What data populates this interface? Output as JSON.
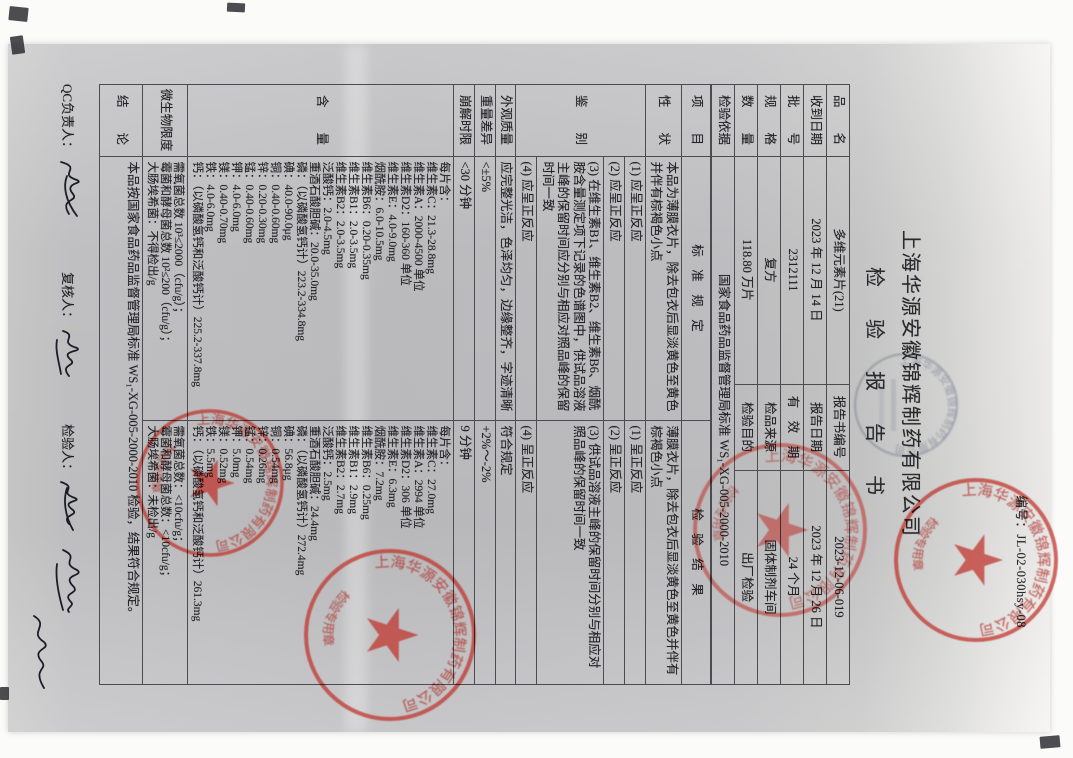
{
  "page": {
    "report_no": "编号：JL-02-030hsy-08",
    "company": "上海华源安徽锦辉制药有限公司",
    "title": "检　验　报　告　书"
  },
  "info": {
    "rows": [
      {
        "l1": "品　　名",
        "v1": "多维元素片(21)",
        "l2": "报告书编号",
        "v2": "2023-12-06-019"
      },
      {
        "l1": "收到日期",
        "v1": "2023 年 12 月 14 日",
        "l2": "报告日期",
        "v2": "2023 年 12 月 26 日"
      },
      {
        "l1": "批　　号",
        "v1": "2312111",
        "l2": "有　效　期",
        "v2": "24 个月"
      },
      {
        "l1": "规　　格",
        "v1": "复方",
        "l2": "检品来源",
        "v2": "固体制剂车间"
      },
      {
        "l1": "数　　量",
        "v1": "118.80 万片",
        "l2": "检验目的",
        "v2": "出厂检验"
      }
    ],
    "basis_label": "检验依据",
    "basis_value": "国家食品药品监督管理局标准 WS₁-XG-005-2000-2010"
  },
  "spec_header": {
    "item": "项　　目",
    "standard": "标　准　规　定",
    "result": "检　验　结　果"
  },
  "rows": {
    "xingzhuang": {
      "label": "性　　状",
      "std": "本品为薄膜衣片，除去包衣后显淡黄色至黄色并伴有棕褐色小点",
      "res": "薄膜衣片，除去包衣后显淡黄色至黄色并伴有棕褐色小点"
    },
    "jianbie": {
      "label": "鉴　　别",
      "subs": [
        {
          "std": "(1) 应呈正反应",
          "res": "(1) 呈正反应"
        },
        {
          "std": "(2) 应呈正反应",
          "res": "(2) 呈正反应"
        },
        {
          "std": "(3) 在维生素B1、维生素B2、维生素B6、烟酰胺含量测定项下记录的色谱图中，供试品溶液主峰的保留时间应分别与相应对照品峰的保留时间一致",
          "res": "(3) 供试品溶液主峰的保留时间分别与相应对照品峰的保留时间一致"
        },
        {
          "std": "(4) 应呈正反应",
          "res": "(4) 呈正反应"
        }
      ]
    },
    "waiguan": {
      "label": "外观质量",
      "std": "应完整光洁，色泽均匀，边缘整齐，字迹清晰",
      "res": "符合规定"
    },
    "zhongliang": {
      "label": "重量差异",
      "std": "<±5%",
      "res": "+2%～-2%"
    },
    "bengjie": {
      "label": "崩解时限",
      "std": "<30 分钟",
      "res": "9 分钟"
    },
    "hanliang": {
      "label": "含　　量",
      "std_lines": [
        "每片含：",
        "维生素C：21.3-28.8mg",
        "维生素A：2000-4500 单位",
        "维生素D2：160-360 单位",
        "维生素E：4.0-9.0mg",
        "烟酰胺：6.0-10.5mg",
        "维生素B6：0.20-0.35mg",
        "维生素B1：2.0-3.5mg",
        "维生素B2：2.0-3.5mg",
        "泛酸钙：2.0-4.5mg",
        "重酒石酸胆碱：20.0-35.0mg",
        "磷：（以磷酸氢钙计）223.2-334.8mg",
        "碘：40.0-90.0μg",
        "铜：0.40-0.60mg",
        "锌：0.20-0.30mg",
        "锰：0.40-0.60mg",
        "钾：4.0-6.0mg",
        "镁：0.40-0.70mg",
        "铁：4.0-6.0mg",
        "钙：（以磷酸氢钙和泛酸钙计）225.2-337.8mg"
      ],
      "res_lines": [
        "每片含：",
        "维生素C：27.0mg",
        "维生素A：2994 单位",
        "维生素D2：306 单位",
        "维生素E：6.3mg",
        "烟酰胺：7.2mg",
        "维生素B6：0.25mg",
        "维生素B1：2.9mg",
        "维生素B2：2.7mg",
        "泛酸钙：2.5mg",
        "重酒石酸胆碱：24.4mg",
        "磷：（以磷酸氢钙计）272.4mg",
        "碘：56.8μg",
        "铜：0.54mg",
        "锌：0.26mg",
        "锰：0.54mg",
        "钾：5.0mg",
        "镁：0.52mg",
        "铁：5.5mg",
        "钙：（以磷酸氢钙和泛酸钙计）261.3mg"
      ]
    },
    "weishengwu": {
      "label": "微生物限度",
      "std_lines": [
        "需氧菌总数 10³≤2000（cfu/g）；",
        "霉菌和酵母菌总数 10²≤200（cfu/g）；",
        "大肠埃希菌：不得检出/g"
      ],
      "res_lines": [
        "需氧菌总数：<10cfu/g；",
        "霉菌和酵母菌总数：<10cfu/g；",
        "大肠埃希菌：未检出/g"
      ]
    },
    "jielun": {
      "label": "结　　论",
      "value": "本品按国家食品药品监督管理局标准 WS₁-XG-005-2000-2010 检验，结果符合规定。"
    }
  },
  "signatures": {
    "qc_label": "QC负责人：",
    "review_label": "复核人：",
    "tester_label": "检验人："
  },
  "stamps": {
    "rim_text": "上海华源安徽锦辉制药有限公司",
    "inner_text": "检验专用章",
    "red_color": "#bf2f27",
    "gray_color": "#4a5570"
  }
}
